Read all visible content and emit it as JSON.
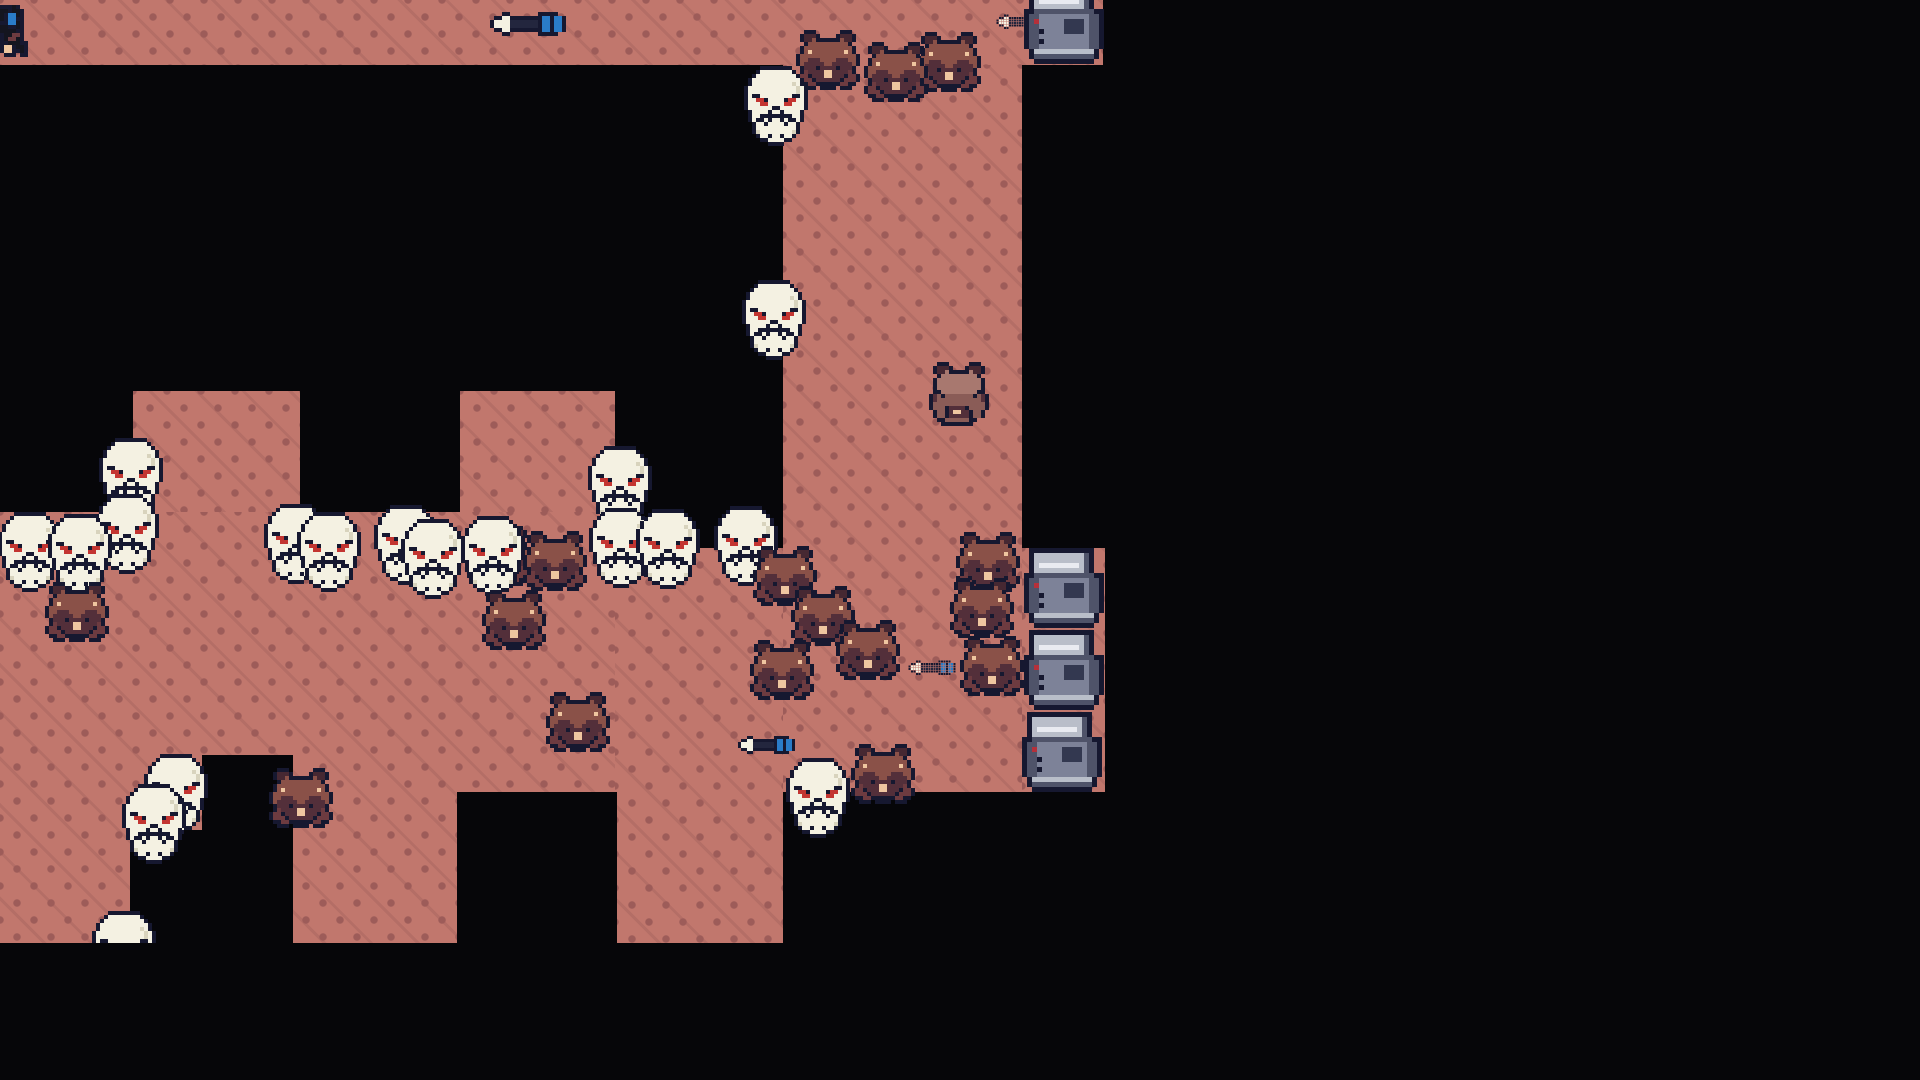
{
  "scene": {
    "width": 1920,
    "height": 1080,
    "background": "#060609"
  },
  "floor_style": {
    "base": "#c1776d",
    "dot": "#9d5c59",
    "line": "rgba(157,92,89,0.35)"
  },
  "regions": {
    "floors": [
      {
        "name": "floor-top-strip",
        "x": 0,
        "y": 0,
        "w": 1103,
        "h": 65
      },
      {
        "name": "floor-right-corridor",
        "x": 783,
        "y": 65,
        "w": 239,
        "h": 727
      },
      {
        "name": "floor-crate-shelf",
        "x": 1022,
        "y": 548,
        "w": 83,
        "h": 244
      },
      {
        "name": "floor-main-hall",
        "x": 0,
        "y": 512,
        "w": 615,
        "h": 431
      },
      {
        "name": "floor-main-step",
        "x": 615,
        "y": 548,
        "w": 168,
        "h": 395
      },
      {
        "name": "floor-column-a",
        "x": 133,
        "y": 391,
        "w": 167,
        "h": 121
      },
      {
        "name": "floor-column-b",
        "x": 460,
        "y": 391,
        "w": 155,
        "h": 121
      }
    ],
    "voids": [
      {
        "name": "darkness-notch-left",
        "x": 202,
        "y": 755,
        "w": 91,
        "h": 188
      },
      {
        "name": "darkness-notch-left-ext",
        "x": 130,
        "y": 830,
        "w": 72,
        "h": 113
      },
      {
        "name": "darkness-notch-right",
        "x": 457,
        "y": 792,
        "w": 160,
        "h": 151
      }
    ]
  },
  "palette": {
    "O": "#161830",
    "W": "#f4f1e2",
    "S": "#d8d3bd",
    "R": "#c33531",
    "H": "#8a5148",
    "E": "#462832",
    "D": "#532f3a",
    "P": "#efc6a0",
    "M": "#6d3b40",
    "h": "#a8786f",
    "b": "#8a5c57",
    "G": "#b9bec9",
    "w": "#e9ebf1",
    "m": "#7d8298",
    "d": "#4f5369",
    "n": "#333850",
    "r": "#b5303a",
    "B": "#2a7cc8",
    "K": "#23263e",
    "k": "#14151f"
  },
  "sprites": {
    "skull": {
      "w": 16,
      "h": 20,
      "scale": 4,
      "rows": [
        "....OOOOOOOO....",
        "...OWWWWWWWWO...",
        "..OWWWWWWWWWWO..",
        ".OWWWWWWWWWWWWO.",
        ".OWWWWWWWWWWSWO.",
        "OWWWWWWWWWWWWSWO",
        "OWWWWWWWWWWWWSWO",
        "OWOOWWWWWWWWOOWO",
        "OWWRROWWWWORRWWO",
        "OWWWRRWWWWRRWWWO",
        "OWWWWWWOOWWWWWWO",
        ".OWWWWOWWOWWWWO.",
        ".OWWOOOOOOOOWWO.",
        ".OWOOWOWWOWOOWO.",
        "..OWWOWWWWOWWO..",
        "..OWWWWWWWWWWO..",
        "..OSWWWWWWWWSO..",
        "...OWWOWWOWWO...",
        "....OOWWWWOO....",
        "......OOOO......"
      ]
    },
    "bear": {
      "w": 16,
      "h": 15,
      "scale": 4,
      "rows": [
        "..OOO......OOO..",
        ".OEEEO....OEEEO.",
        ".OEEHOOOOOOHEEO.",
        "..OHHHHHHHHHHO..",
        ".OHHHHHHHHHHHHO.",
        ".OHPHHHHHHHHPHO.",
        "OHHHHHHHHHHHHHHO",
        "OHHDDDHHHHDDDHHO",
        "OHDDDDDHHDDDDDHO",
        ".ODDDODDDDODDDO.",
        ".OMDDDDPPDDDDMO.",
        "OMMODDDPPDDDOMMO",
        "OMMMODDDDDDOMMMO",
        ".OOMMOOOOOOMMOO.",
        "..OOO.OOOO.OOO.."
      ]
    },
    "bearback": {
      "w": 15,
      "h": 16,
      "scale": 4,
      "rows": [
        "..OOO.....OOO..",
        ".OEEEO...OEEEO.",
        ".OEEhOOOOOhEEO.",
        "..OhhhhhhhhhO..",
        ".OhhhhhhhhhhhO.",
        ".OhhhhhhhhhhhO.",
        ".OhhhhhhhhhhhO.",
        ".OOhhhhhhhhhOO.",
        "ODbObbbbbbbObDO",
        "ODbbbbbbbbbbbDO",
        "ObbbbbbbbbbbbbO",
        "ObbbODDDDObbbbO",
        ".ObbODPPDDObbO.",
        ".ObbODDDDDObbO.",
        "..OObbbbbbOO...",
        "...OOOOOOOO...."
      ]
    },
    "crate": {
      "w": 16,
      "h": 16,
      "scale": 5,
      "rows": [
        ".OOOOOOOOOOOOO..",
        ".OGGGGGGGGGGdO..",
        ".OGGGGGGGGGGdO..",
        ".OGwwwwwwwwGdO..",
        ".OGGGGGGGGGGdO..",
        "OOddddddddddddOO",
        "OddmmmmmmmmmmddO",
        "OdrmmmmmnnnnmddO",
        "OddmmmmmnnnnmddO",
        "OddOmmmmnnnnmddO",
        "OddmmmmmmmmmmddO",
        "OddOmmmmmmmmmddO",
        "OddmmmmmmmmmmddO",
        ".OGGGGGGGGGGGGO.",
        ".OddddddddddddO.",
        "..OOOOOOOOOOOO.."
      ]
    },
    "arrow": {
      "w": 19,
      "h": 6,
      "scale": 3,
      "rows": [
        "...OO.......OOOOO..",
        ".OOWWOOOOOOOOBBOBBO",
        "OWWWWKKKKKKKOBBOBBO",
        "OWWWWKKKKKKKOBBOBBO",
        ".OOWWOOOOOOOOBBOBBO",
        "...OO.......OOOOO.."
      ]
    },
    "itempile": {
      "w": 9,
      "h": 14,
      "scale": 4,
      "rows": [
        "OOOkO....",
        "kkOkkO...",
        "kOBBkO...",
        "kOBBOO...",
        "OOBBkO...",
        "kkOOkO...",
        "kkkkOO...",
        "OkkMMO...",
        "OkMMkO...",
        "OOkkkOO..",
        "OPPOkkO..",
        "OPPOOkO..",
        ".OOO.OO..",
        "........."
      ]
    }
  },
  "entities": [
    {
      "type": "itempile",
      "name": "dropped-items",
      "x": 0,
      "y": 5
    },
    {
      "type": "arrow",
      "name": "arrow-item",
      "x": 490,
      "y": 12,
      "s": 4
    },
    {
      "type": "crate",
      "name": "metal-crate",
      "x": 1024,
      "y": -16
    },
    {
      "type": "arrow",
      "name": "arrow-item",
      "x": 996,
      "y": 14,
      "s": 2.5
    },
    {
      "type": "bear",
      "name": "bear-enemy",
      "x": 796,
      "y": 30
    },
    {
      "type": "bear",
      "name": "bear-enemy",
      "x": 864,
      "y": 42
    },
    {
      "type": "bear",
      "name": "bear-enemy",
      "x": 917,
      "y": 32
    },
    {
      "type": "skull",
      "name": "skull-enemy",
      "x": 744,
      "y": 66
    },
    {
      "type": "skull",
      "name": "skull-enemy",
      "x": 742,
      "y": 280
    },
    {
      "type": "bearback",
      "name": "bear-facing-away",
      "x": 929,
      "y": 362
    },
    {
      "type": "skull",
      "name": "skull-enemy",
      "x": 99,
      "y": 438
    },
    {
      "type": "skull",
      "name": "skull-enemy",
      "x": 95,
      "y": 494
    },
    {
      "type": "skull",
      "name": "skull-enemy",
      "x": -2,
      "y": 512
    },
    {
      "type": "skull",
      "name": "skull-enemy",
      "x": 48,
      "y": 514
    },
    {
      "type": "skull",
      "name": "skull-enemy",
      "x": 264,
      "y": 504
    },
    {
      "type": "skull",
      "name": "skull-enemy",
      "x": 297,
      "y": 512
    },
    {
      "type": "skull",
      "name": "skull-enemy",
      "x": 374,
      "y": 505
    },
    {
      "type": "skull",
      "name": "skull-enemy",
      "x": 401,
      "y": 519
    },
    {
      "type": "skull",
      "name": "skull-enemy",
      "x": 588,
      "y": 446
    },
    {
      "type": "skull",
      "name": "skull-enemy",
      "x": 589,
      "y": 508
    },
    {
      "type": "skull",
      "name": "skull-enemy",
      "x": 636,
      "y": 509
    },
    {
      "type": "skull",
      "name": "skull-enemy",
      "x": 714,
      "y": 506
    },
    {
      "type": "skull",
      "name": "skull-enemy",
      "x": 461,
      "y": 516
    },
    {
      "type": "bear",
      "name": "bear-enemy",
      "x": 467,
      "y": 526
    },
    {
      "type": "bear",
      "name": "bear-enemy",
      "x": 523,
      "y": 531
    },
    {
      "type": "bear",
      "name": "bear-enemy",
      "x": 482,
      "y": 590
    },
    {
      "type": "bear",
      "name": "bear-enemy",
      "x": 546,
      "y": 692
    },
    {
      "type": "bear",
      "name": "bear-enemy",
      "x": 45,
      "y": 582
    },
    {
      "type": "bear",
      "name": "bear-enemy",
      "x": 753,
      "y": 546
    },
    {
      "type": "bear",
      "name": "bear-enemy",
      "x": 791,
      "y": 586
    },
    {
      "type": "bear",
      "name": "bear-enemy",
      "x": 836,
      "y": 620
    },
    {
      "type": "bear",
      "name": "bear-enemy",
      "x": 750,
      "y": 640
    },
    {
      "type": "bear",
      "name": "bear-enemy",
      "x": 956,
      "y": 532
    },
    {
      "type": "bear",
      "name": "bear-enemy",
      "x": 950,
      "y": 578
    },
    {
      "type": "bear",
      "name": "bear-enemy",
      "x": 960,
      "y": 636
    },
    {
      "type": "arrow",
      "name": "arrow-item",
      "x": 908,
      "y": 660,
      "s": 2.5
    },
    {
      "type": "crate",
      "name": "metal-crate",
      "x": 1024,
      "y": 548
    },
    {
      "type": "crate",
      "name": "metal-crate",
      "x": 1024,
      "y": 630
    },
    {
      "type": "crate",
      "name": "metal-crate",
      "x": 1022,
      "y": 712
    },
    {
      "type": "arrow",
      "name": "arrow-item",
      "x": 738,
      "y": 736,
      "s": 3
    },
    {
      "type": "skull",
      "name": "skull-enemy",
      "x": 786,
      "y": 758
    },
    {
      "type": "bear",
      "name": "bear-enemy",
      "x": 851,
      "y": 744
    },
    {
      "type": "bear",
      "name": "bear-enemy",
      "x": 269,
      "y": 768
    },
    {
      "type": "skull",
      "name": "skull-enemy",
      "x": 144,
      "y": 754
    },
    {
      "type": "skull",
      "name": "skull-enemy",
      "x": 122,
      "y": 784
    },
    {
      "type": "skull",
      "name": "skull-enemy",
      "x": 92,
      "y": 911,
      "clip": 32
    }
  ]
}
